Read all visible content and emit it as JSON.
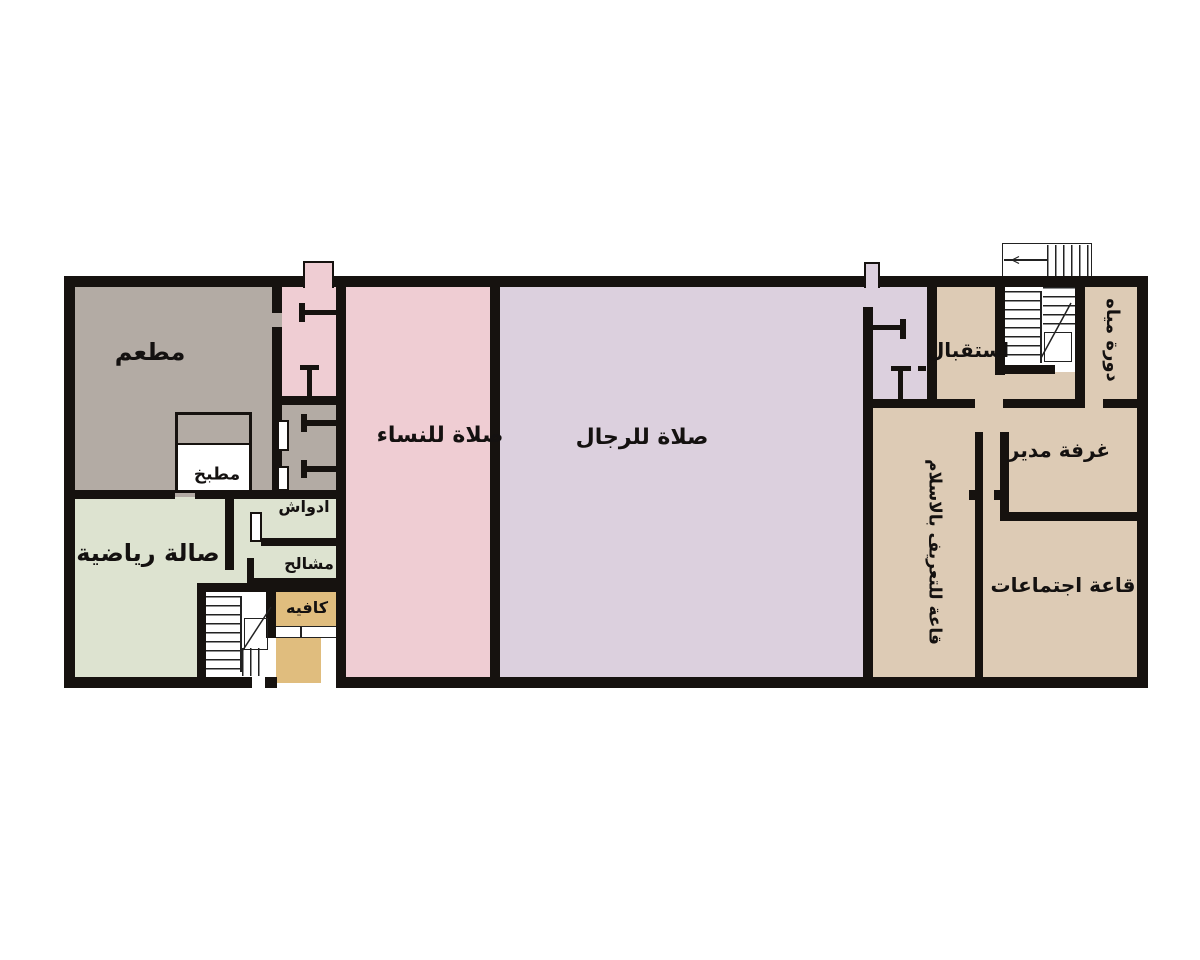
{
  "plan": {
    "title": "Floor plan — Islamic center ground floor",
    "wall_color": "#16120f",
    "stair_line_color": "#222222",
    "rooms": {
      "restaurant": {
        "label": "مطعم",
        "color": "#b3aba4"
      },
      "kitchen": {
        "label": "مطبخ",
        "color": "#b3aba4"
      },
      "gym": {
        "label": "صالة رياضية",
        "color": "#dde3d0"
      },
      "showers": {
        "label": "ادواش",
        "color": "#dde3d0"
      },
      "changing": {
        "label": "مشالح",
        "color": "#dde3d0"
      },
      "cafe": {
        "label": "كافيه",
        "color": "#e0bd7e"
      },
      "women_prayer": {
        "label": "صلاة للنساء",
        "color": "#efcdd3"
      },
      "men_prayer": {
        "label": "صلاة للرجال",
        "color": "#dcd0de"
      },
      "reception": {
        "label": "استقبال",
        "color": "#ddcbb5"
      },
      "wc": {
        "label": "دورة مياه",
        "color": "#ddcbb5"
      },
      "manager": {
        "label": "غرفة مدير",
        "color": "#ddcbb5"
      },
      "meeting": {
        "label": "قاعة اجتماعات",
        "color": "#ddcbb5"
      },
      "islam_hall": {
        "label": "قاعة للتعريف بالاسلام",
        "color": "#ddcbb5"
      },
      "corridor_women": {
        "color": "#efcdd3"
      },
      "corridor_men": {
        "color": "#dcd0de"
      }
    }
  }
}
